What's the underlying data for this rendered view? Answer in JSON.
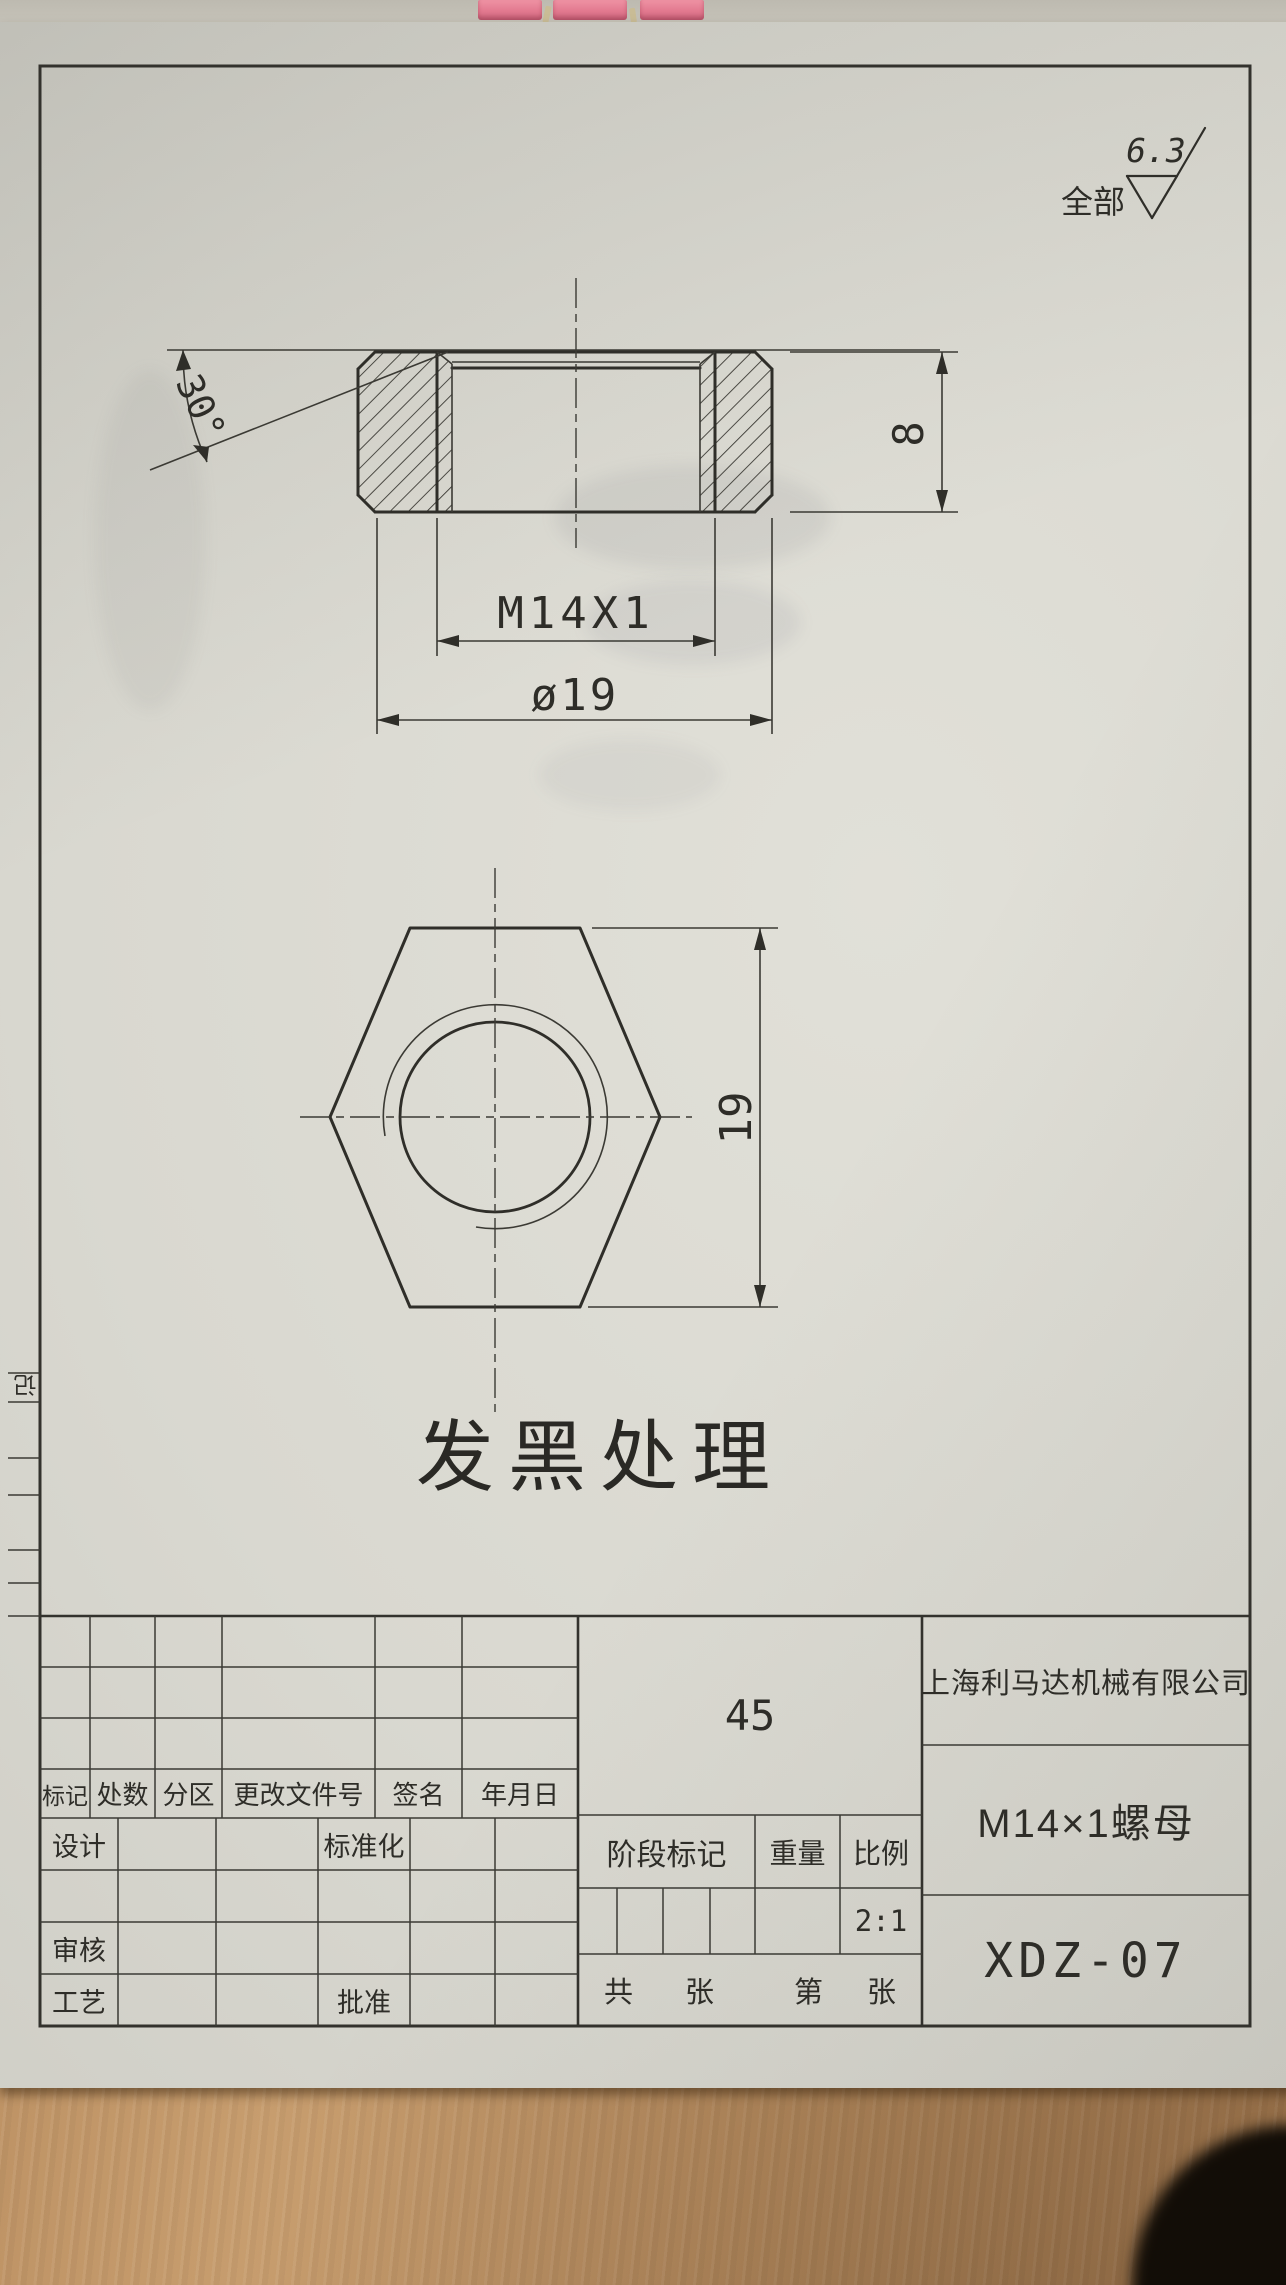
{
  "surface_finish": {
    "scope": "全部",
    "value": "6.3"
  },
  "dimensions": {
    "chamfer_angle": "30°",
    "height": "8",
    "thread": "M14X1",
    "outer_diameter": "ø19",
    "across_flats": "19"
  },
  "note": "发黑处理",
  "margin_strip": {
    "label": "记"
  },
  "title_block": {
    "revision_headers": [
      "标记",
      "处数",
      "分区",
      "更改文件号",
      "签名",
      "年月日"
    ],
    "design_label": "设计",
    "standardization_label": "标准化",
    "check_label": "审核",
    "process_label": "工艺",
    "approve_label": "批准",
    "material": "45",
    "stage_mark_label": "阶段标记",
    "weight_label": "重量",
    "scale_label": "比例",
    "scale_value": "2:1",
    "sheets_total_prefix": "共",
    "sheets_total_suffix": "张",
    "sheet_number_prefix": "第",
    "sheet_number_suffix": "张",
    "company": "上海利马达机械有限公司",
    "part_name": "M14×1螺母",
    "drawing_number": "XDZ-07"
  }
}
